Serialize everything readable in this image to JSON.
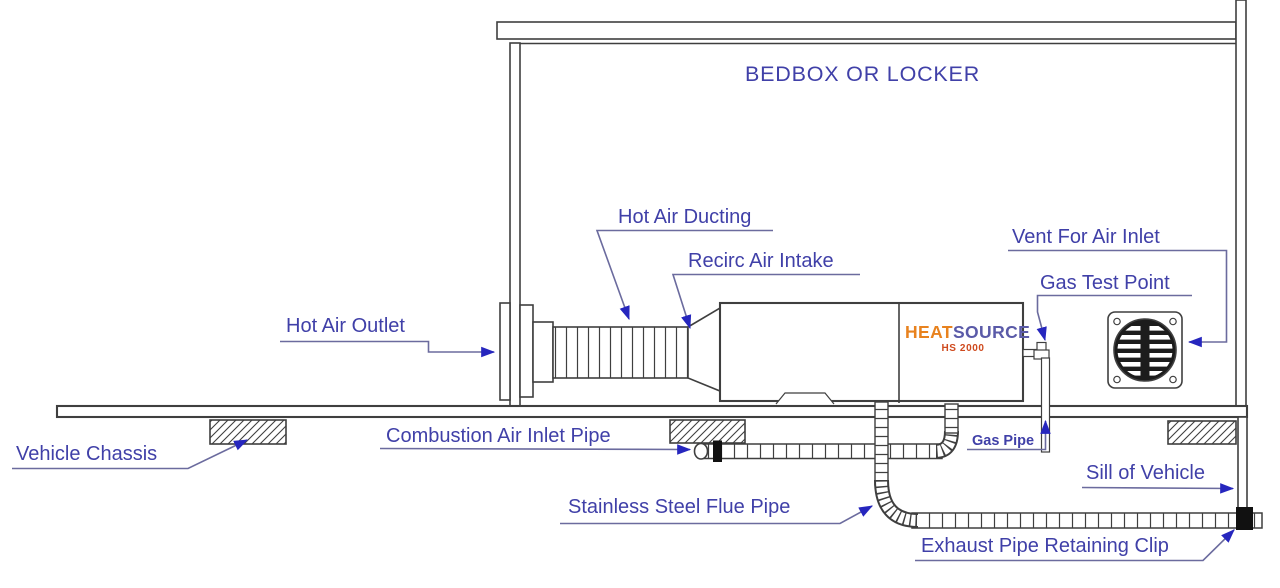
{
  "title": "BEDBOX OR LOCKER",
  "labels": {
    "hot_air_outlet": "Hot Air Outlet",
    "hot_air_ducting": "Hot Air Ducting",
    "recirc_air_intake": "Recirc Air Intake",
    "vent_for_air_inlet": "Vent For Air Inlet",
    "gas_test_point": "Gas Test Point",
    "vehicle_chassis": "Vehicle Chassis",
    "combustion_air_inlet_pipe": "Combustion Air Inlet Pipe",
    "gas_pipe": "Gas Pipe",
    "sill_of_vehicle": "Sill of Vehicle",
    "stainless_steel_flue_pipe": "Stainless Steel Flue Pipe",
    "exhaust_pipe_retaining_clip": "Exhaust Pipe Retaining Clip"
  },
  "heater": {
    "brand_heat": "HEAT",
    "brand_source": "SOURCE",
    "model": "HS 2000"
  },
  "colors": {
    "label_text": "#4040a8",
    "leader_line": "#6b6b9e",
    "arrowhead": "#2626be",
    "drawing_line": "#3f3f3f",
    "brand_heat_orange": "#e8821e",
    "brand_source_blue": "#5a5aa8",
    "model_red": "#cf4a1e",
    "background": "#ffffff"
  }
}
